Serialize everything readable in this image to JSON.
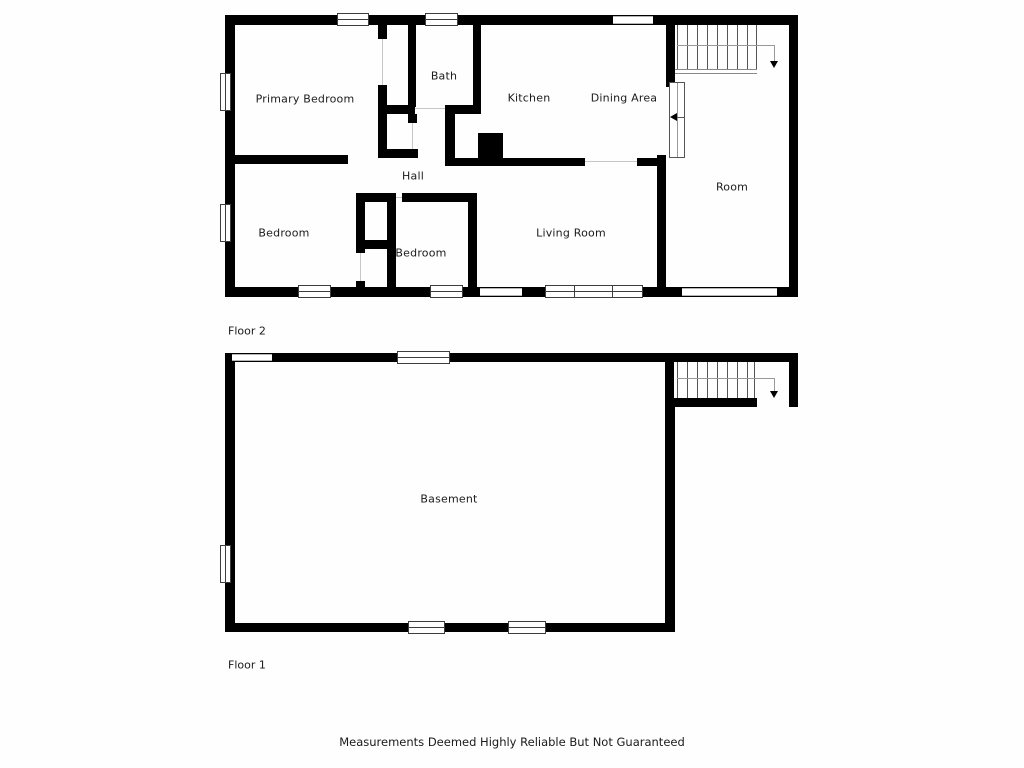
{
  "colors": {
    "wall": "#000000",
    "window_border": "#3d3d3d",
    "stair_tread_line": "#555555",
    "stair_run_line": "#999999",
    "text": "#1b1b1b",
    "background": "#fefefe"
  },
  "floor2": {
    "label": "Floor 2",
    "rooms": {
      "primary_bedroom": "Primary Bedroom",
      "bath": "Bath",
      "kitchen": "Kitchen",
      "dining_area": "Dining Area",
      "hall": "Hall",
      "bedroom_west": "Bedroom",
      "bedroom_middle": "Bedroom",
      "living_room": "Living Room",
      "room": "Room"
    }
  },
  "floor1": {
    "label": "Floor 1",
    "rooms": {
      "basement": "Basement"
    }
  },
  "footer": {
    "disclaimer": "Measurements Deemed Highly Reliable But Not Guaranteed"
  }
}
